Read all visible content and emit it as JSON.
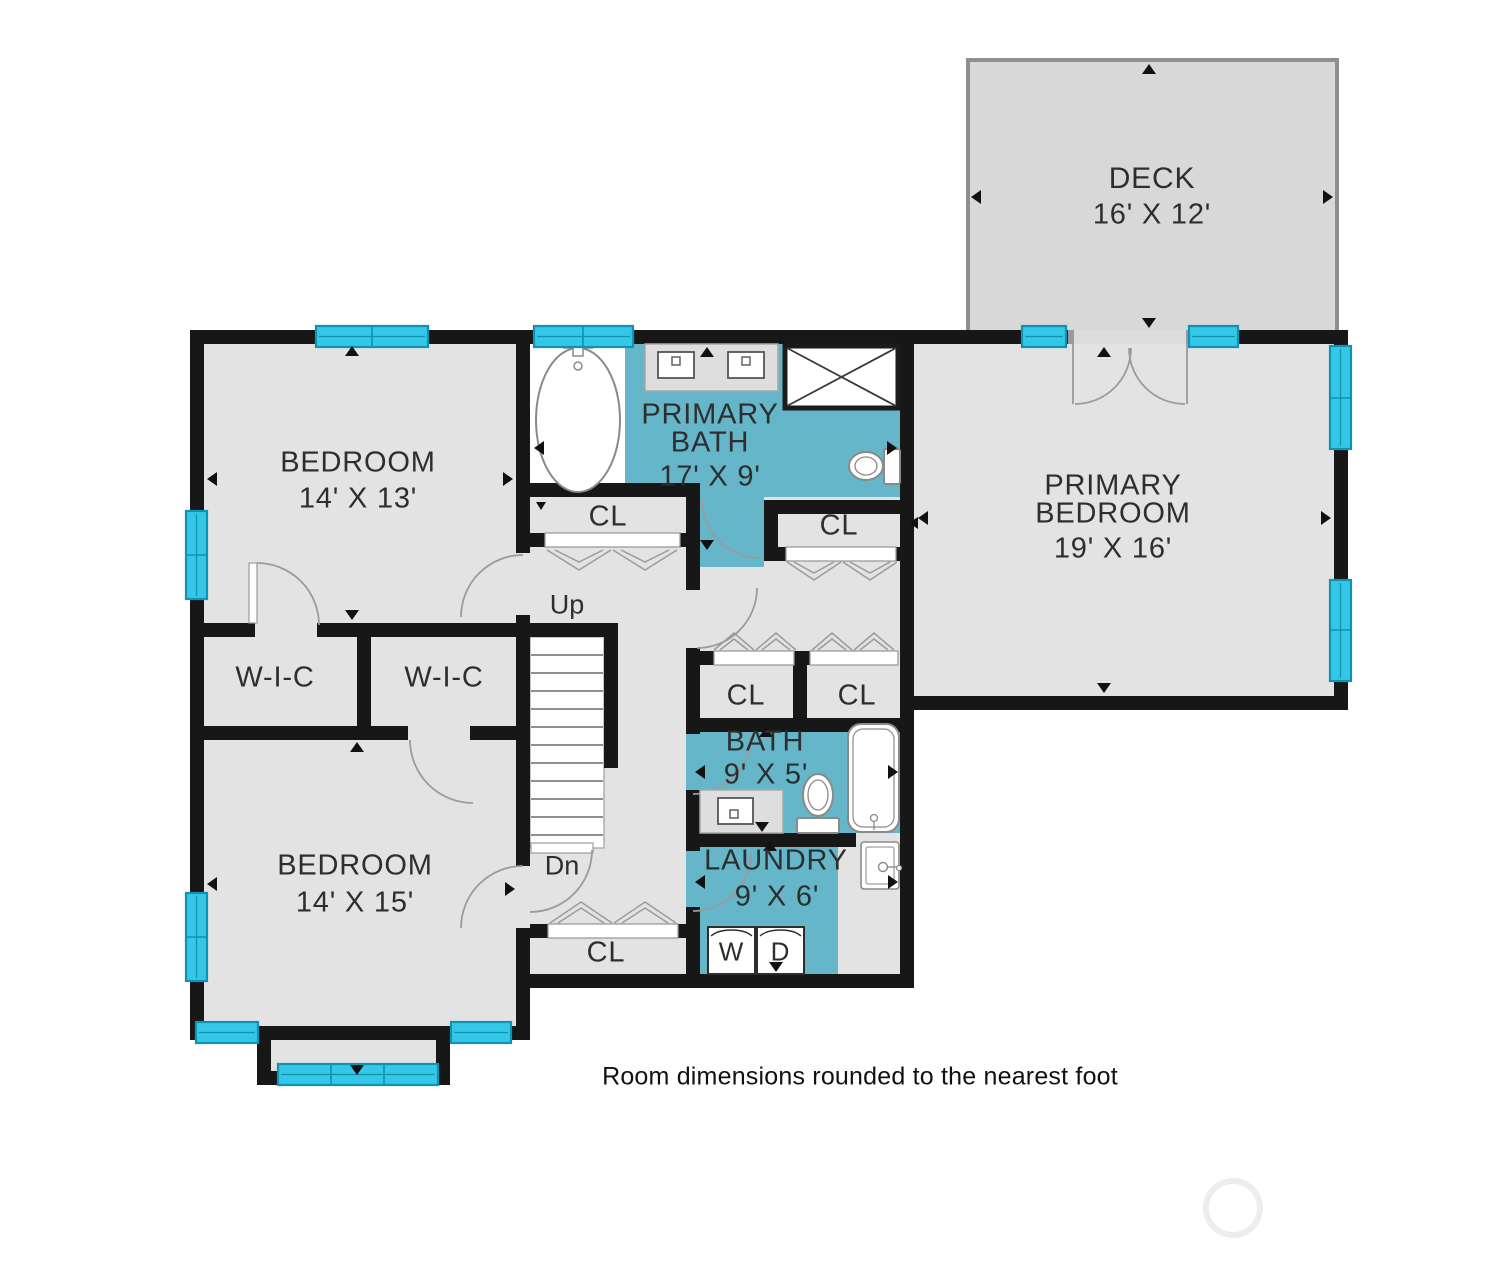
{
  "note": "Room dimensions rounded to the nearest foot",
  "rooms": {
    "deck": {
      "name": "DECK",
      "dims": "16' X 12'"
    },
    "bedroom_top": {
      "name": "BEDROOM",
      "dims": "14' X 13'"
    },
    "primary_bath": {
      "line1": "PRIMARY",
      "line2": "BATH",
      "dims": "17' X 9'"
    },
    "primary_bedroom": {
      "line1": "PRIMARY",
      "line2": "BEDROOM",
      "dims": "19' X 16'"
    },
    "wic_left": {
      "name": "W-I-C"
    },
    "wic_right": {
      "name": "W-I-C"
    },
    "bedroom_bottom": {
      "name": "BEDROOM",
      "dims": "14' X 15'"
    },
    "bath": {
      "name": "BATH",
      "dims": "9' X 5'"
    },
    "laundry": {
      "name": "LAUNDRY",
      "dims": "9' X 6'"
    }
  },
  "closets": {
    "upper_left": "CL",
    "upper_right": "CL",
    "mid_left": "CL",
    "mid_right": "CL",
    "bottom": "CL"
  },
  "stairs": {
    "up": "Up",
    "down": "Dn"
  },
  "appliances": {
    "washer": "W",
    "dryer": "D"
  },
  "colors": {
    "wall": "#171717",
    "floor": "#e3e3e3",
    "bath_floor": "#64b6c8",
    "window": "#35c7e7",
    "window_frame": "#0e93b2",
    "deck_floor": "#d8d8d8",
    "deck_border": "#8f8f8f",
    "door_stroke": "#9b9b9b",
    "text": "#2e2e2e"
  }
}
